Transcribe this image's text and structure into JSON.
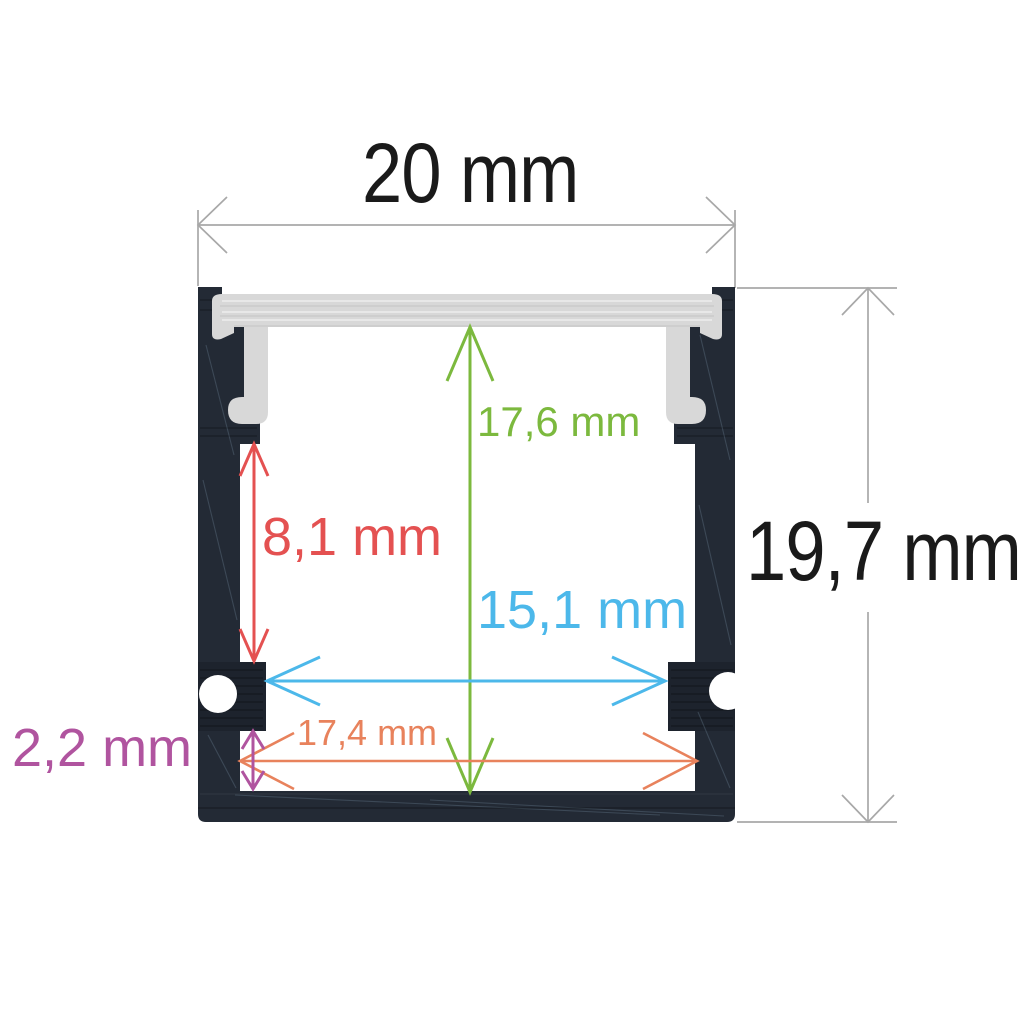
{
  "drawing": {
    "background": "#ffffff",
    "line_color": "#a8a8a8",
    "profile": {
      "body_color": "#232a35",
      "body_shade_color": "rgba(0,0,0,0.15)",
      "diffuser_color": "#d8d8d8",
      "cavity_color": "#ffffff",
      "screw_groove_color": "#ffffff"
    },
    "dimensions": [
      {
        "id": "outer-width",
        "label": "20 mm",
        "color": "#1a1a1a",
        "orientation": "horizontal",
        "location": "top"
      },
      {
        "id": "outer-height",
        "label": "19,7 mm",
        "color": "#1a1a1a",
        "orientation": "vertical",
        "location": "right"
      },
      {
        "id": "inner-height",
        "label": "17,6 mm",
        "color": "#7cb93e",
        "orientation": "vertical",
        "location": "center"
      },
      {
        "id": "upper-side-height",
        "label": "8,1 mm",
        "color": "#e45151",
        "orientation": "vertical",
        "location": "upper-left"
      },
      {
        "id": "mid-inner-width",
        "label": "15,1 mm",
        "color": "#4cb8ea",
        "orientation": "horizontal",
        "location": "middle"
      },
      {
        "id": "bottom-inner-width",
        "label": "17,4 mm",
        "color": "#e8825c",
        "orientation": "horizontal",
        "location": "bottom"
      },
      {
        "id": "bottom-ledge-height",
        "label": "2,2 mm",
        "color": "#b0549f",
        "orientation": "vertical",
        "location": "lower-left"
      }
    ]
  }
}
